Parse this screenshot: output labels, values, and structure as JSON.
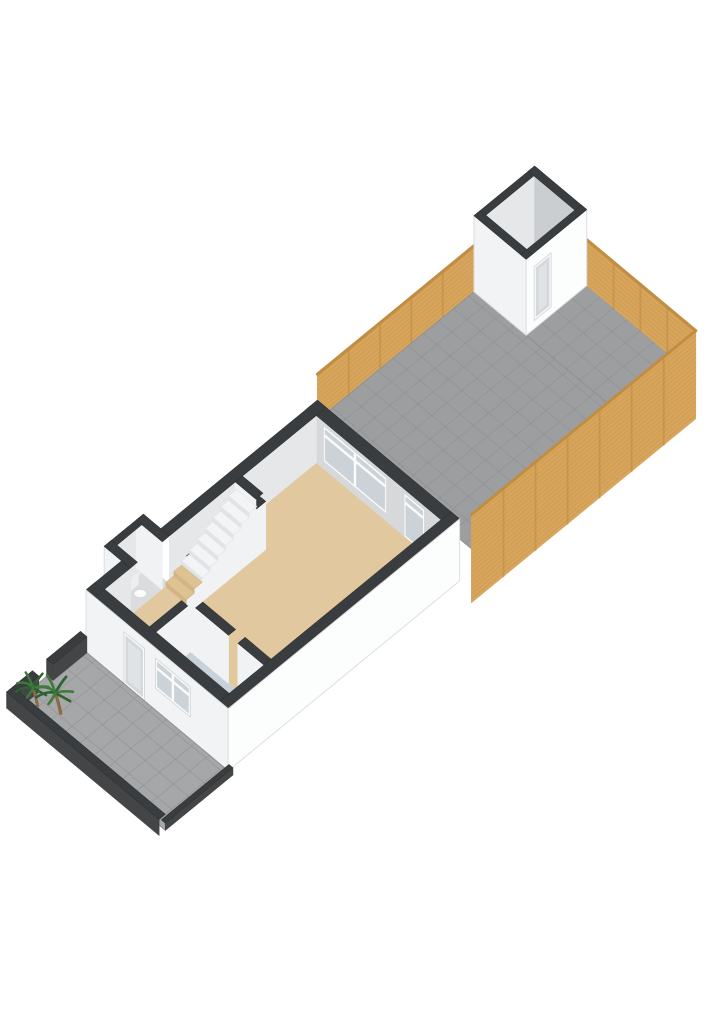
{
  "meta": {
    "view": "3d-floorplan-ground-floor-with-garden",
    "background": "#ffffff"
  },
  "palette": {
    "background": "#ffffff",
    "wallTop": "#3a3d3f",
    "wallTopStroke": "#2f3234",
    "extWhite": "#f2f3f5",
    "extWhiteBright": "#fcfdfd",
    "extEdge": "#dcdee0",
    "innerGray": "#d6d8da",
    "innerGrayLight": "#e5e7e9",
    "innerGrayDark": "#cbced0",
    "intWallFace": "#f1f2f3",
    "floorBeige": "#e2c89e",
    "floorBeigeEdge": "#d6ba8e",
    "stepBeige": "#dec292",
    "stepBeigeRiser": "#d2b485",
    "vestibuleBlue": "#c8d2da",
    "wcFloor": "#dadcde",
    "pavingGray": "#a5a7a9",
    "gardenPaving": "#9c9ea0",
    "pavingGrid": "#8b8d8f",
    "pavingEdge": "#8f9193",
    "wood": "#d8a55c",
    "woodDark": "#b9873c",
    "woodRail": "#c08d42",
    "stepWhite": "#f3f4f5",
    "stepRiser": "#e1e3e5",
    "glass": "#ccd3d8",
    "frame": "#fafbfb",
    "frameEdge": "#d7dadc",
    "doorPanel": "#d5d8da",
    "doorInset": "#e0e3e5",
    "shedFloor": "#a9abad",
    "lowWallFace": "#434547",
    "plantGreen": "#3e7b3c",
    "plantGreenDark": "#2e6330",
    "trunk": "#8a6a42",
    "toiletWhite": "#fafbfc",
    "toiletEdge": "#d7dadc"
  },
  "scene": {
    "projection": {
      "origin": [
        86,
        652
      ],
      "eu": [
        17.8,
        -14.6
      ],
      "ev": [
        15.8,
        13.2
      ]
    },
    "elevations": {
      "street": 0,
      "floor": 14,
      "garden": 42,
      "houseWallTop": 62,
      "fenceTop": 88,
      "shedWallTop": 118,
      "lowWallTop": 16
    },
    "items": [
      {
        "name": "garden-fence-left",
        "type": "wallV",
        "v": 0,
        "u": [
          13,
          21.8
        ],
        "e": [
          42,
          88
        ],
        "fill": "wood",
        "slats": true,
        "postStep": 1.76,
        "rail": true
      },
      {
        "name": "garden-paving-main",
        "type": "hquad",
        "u": [
          13,
          21.8
        ],
        "v": [
          0,
          10.2
        ],
        "e": 42,
        "fill": "gardenPaving",
        "grid": 0.85,
        "stroke": "pavingEdge"
      },
      {
        "name": "garden-paving-back",
        "type": "hquad",
        "u": [
          21.8,
          25.2
        ],
        "v": [
          3.3,
          10.2
        ],
        "e": 42,
        "fill": "gardenPaving",
        "grid": 0.85,
        "stroke": "pavingEdge"
      },
      {
        "name": "garden-plant",
        "type": "tuft",
        "at": [
          22.6,
          9.5,
          42
        ]
      },
      {
        "name": "garden-fence-back",
        "type": "wallU",
        "u": 25.2,
        "v": [
          3.3,
          10.2
        ],
        "e": [
          42,
          88
        ],
        "fill": "wood",
        "slats": true,
        "postStep": 1.7,
        "rail": true
      },
      {
        "name": "shed-floor",
        "type": "hquad",
        "u": [
          21.8,
          25.2
        ],
        "v": [
          0,
          3.3
        ],
        "e": 42,
        "fill": "shedFloor"
      },
      {
        "name": "shed-wall-back-left-inner",
        "type": "wallV",
        "v": 0,
        "u": [
          21.8,
          25.2
        ],
        "e": [
          42,
          118
        ],
        "fill": "innerGrayLight"
      },
      {
        "name": "shed-wall-back-right-inner",
        "type": "wallU",
        "u": 25.2,
        "v": [
          0,
          3.3
        ],
        "e": [
          42,
          118
        ],
        "fill": "innerGrayDark"
      },
      {
        "name": "shed-wall-back-left-top",
        "type": "hquad",
        "u": [
          21.8,
          25.2
        ],
        "v": [
          0,
          0.35
        ],
        "e": 118,
        "fill": "wallTop"
      },
      {
        "name": "shed-wall-back-right-top",
        "type": "hquad",
        "u": [
          24.85,
          25.2
        ],
        "v": [
          0,
          3.3
        ],
        "e": 118,
        "fill": "wallTop"
      },
      {
        "name": "shed-wall-front-left",
        "type": "wallU",
        "u": 21.8,
        "v": [
          0,
          3.3
        ],
        "e": [
          42,
          118
        ],
        "fill": "extWhite",
        "stroke": "extEdge"
      },
      {
        "name": "shed-wall-front-left-top",
        "type": "hquad",
        "u": [
          21.8,
          22.15
        ],
        "v": [
          0,
          3.3
        ],
        "e": 118,
        "fill": "wallTop"
      },
      {
        "name": "shed-wall-front-right",
        "type": "wallV",
        "v": 3.3,
        "u": [
          21.8,
          25.2
        ],
        "e": [
          42,
          118
        ],
        "fill": "extWhiteBright",
        "stroke": "extEdge"
      },
      {
        "name": "shed-door",
        "type": "winV",
        "v": 3.3,
        "u": [
          22.25,
          23.2
        ],
        "e": [
          50,
          104
        ],
        "style": "door"
      },
      {
        "name": "shed-wall-front-right-top",
        "type": "hquad",
        "u": [
          21.8,
          25.2
        ],
        "v": [
          2.95,
          3.3
        ],
        "e": 118,
        "fill": "wallTop"
      },
      {
        "name": "garden-fence-right",
        "type": "wallV",
        "v": 10.2,
        "u": [
          12.6,
          25.2
        ],
        "e": [
          0,
          88
        ],
        "fill": "wood",
        "slats": true,
        "postStep": 1.8,
        "rail": true
      },
      {
        "name": "house-wall-rear-inner",
        "type": "wallU",
        "u": 12.45,
        "v": [
          0.55,
          8.45
        ],
        "e": [
          14,
          62
        ],
        "fill": "innerGray"
      },
      {
        "name": "rear-window",
        "type": "winU",
        "u": 12.45,
        "v": [
          1.0,
          5.0
        ],
        "e": [
          22,
          58
        ],
        "style": "window",
        "cols": 2,
        "transom": true
      },
      {
        "name": "rear-garden-door",
        "type": "winU",
        "u": 12.45,
        "v": [
          6.1,
          7.4
        ],
        "e": [
          14,
          58
        ],
        "style": "glassdoor",
        "cols": 1,
        "transom": true
      },
      {
        "name": "wc-floor",
        "type": "hquad",
        "u": [
          2.0,
          4.2
        ],
        "v": [
          -1.1,
          0.55
        ],
        "e": 14,
        "fill": "wcFloor"
      },
      {
        "name": "wc-wall-left-inner",
        "type": "wallV",
        "v": -0.75,
        "u": [
          2.0,
          4.2
        ],
        "e": [
          14,
          62
        ],
        "fill": "innerGrayLight"
      },
      {
        "name": "wc-wall-rear-inner",
        "type": "wallU",
        "u": 3.8,
        "v": [
          -1.1,
          0.55
        ],
        "e": [
          14,
          62
        ],
        "fill": "intWallFace"
      },
      {
        "name": "toilet",
        "type": "toilet",
        "at": [
          3.05,
          -0.35,
          14
        ]
      },
      {
        "name": "wc-wall-front-ext",
        "type": "wallU",
        "u": 2.0,
        "v": [
          -1.1,
          0.55
        ],
        "e": [
          0,
          62
        ],
        "fill": "extWhite",
        "stroke": "extEdge"
      },
      {
        "name": "wc-wall-left-top",
        "type": "hquad",
        "u": [
          2.0,
          4.2
        ],
        "v": [
          -1.1,
          -0.75
        ],
        "e": 62,
        "fill": "wallTop"
      },
      {
        "name": "wc-wall-front-top",
        "type": "hquad",
        "u": [
          2.0,
          2.4
        ],
        "v": [
          -1.1,
          0.55
        ],
        "e": 62,
        "fill": "wallTop"
      },
      {
        "name": "wc-wall-rear-top",
        "type": "hquad",
        "u": [
          3.8,
          4.2
        ],
        "v": [
          -1.1,
          0.55
        ],
        "e": 62,
        "fill": "wallTop"
      },
      {
        "name": "house-wall-left-inner-front",
        "type": "wallV",
        "v": 0.55,
        "u": [
          0.55,
          2.0
        ],
        "e": [
          14,
          62
        ],
        "fill": "innerGrayLight"
      },
      {
        "name": "house-wall-left-inner-rear",
        "type": "wallV",
        "v": 0.55,
        "u": [
          4.2,
          12.45
        ],
        "e": [
          14,
          62
        ],
        "fill": "innerGrayLight"
      },
      {
        "name": "living-room-floor",
        "type": "hquad",
        "u": [
          0.55,
          12.45
        ],
        "v": [
          0.55,
          8.45
        ],
        "e": 14,
        "fill": "floorBeige"
      },
      {
        "name": "vestibule-floor",
        "type": "hquad",
        "u": [
          0.55,
          2.5
        ],
        "v": [
          3.8,
          6.8
        ],
        "e": 14.3,
        "fill": "vestibuleBlue"
      },
      {
        "name": "wall-vestibule-left-face",
        "type": "wallV",
        "v": 3.8,
        "u": [
          0.55,
          2.5
        ],
        "e": [
          14,
          62
        ],
        "fill": "intWallFace"
      },
      {
        "name": "wall-vestibule-left-top",
        "type": "hquad",
        "u": [
          0.55,
          2.5
        ],
        "v": [
          3.4,
          3.8
        ],
        "e": 62,
        "fill": "wallTop"
      },
      {
        "name": "wall-vestibule-rear-face",
        "type": "wallU",
        "u": 2.5,
        "v": [
          3.8,
          6.2
        ],
        "e": [
          14,
          62
        ],
        "fill": "intWallFace"
      },
      {
        "name": "wall-vestibule-rear-top",
        "type": "hquad",
        "u": [
          2.5,
          2.9
        ],
        "v": [
          3.8,
          6.2
        ],
        "e": 62,
        "fill": "wallTop"
      },
      {
        "name": "wall-front-right-stub-face",
        "type": "wallU",
        "u": 2.5,
        "v": [
          6.8,
          8.45
        ],
        "e": [
          14,
          62
        ],
        "fill": "intWallFace"
      },
      {
        "name": "wall-front-right-stub-top",
        "type": "hquad",
        "u": [
          2.5,
          2.9
        ],
        "v": [
          6.8,
          8.45
        ],
        "e": 62,
        "fill": "wallTop"
      },
      {
        "name": "wall-stairs-face",
        "type": "wallV",
        "v": 2.25,
        "u": [
          4.0,
          8.1
        ],
        "e": [
          14,
          62
        ],
        "fill": "intWallFace"
      },
      {
        "name": "wall-stairs-end-face",
        "type": "wallU",
        "u": 4.0,
        "v": [
          1.85,
          2.25
        ],
        "e": [
          14,
          62
        ],
        "fill": "intWallFace"
      },
      {
        "name": "wall-stairs-top",
        "type": "hquad",
        "u": [
          4.0,
          8.1
        ],
        "v": [
          1.85,
          2.25
        ],
        "e": 62,
        "fill": "wallTop"
      },
      {
        "name": "wall-stairs-rear-stub-face",
        "type": "wallU",
        "u": 7.9,
        "v": [
          0.55,
          1.85
        ],
        "e": [
          14,
          62
        ],
        "fill": "intWallFace"
      },
      {
        "name": "wall-stairs-rear-stub-top",
        "type": "hquad",
        "u": [
          7.9,
          8.3
        ],
        "v": [
          0.55,
          1.85
        ],
        "e": 62,
        "fill": "wallTop"
      },
      {
        "name": "staircase",
        "type": "steps",
        "u0": 4.0,
        "du": 0.44,
        "n": 9,
        "v": [
          0.55,
          1.85
        ],
        "e0": 14,
        "de": 4.4,
        "beige": 2
      },
      {
        "name": "house-wall-front-top",
        "type": "hquad",
        "u": [
          0,
          0.55
        ],
        "v": [
          0,
          9
        ],
        "e": 62,
        "fill": "wallTop"
      },
      {
        "name": "house-wall-rear-top",
        "type": "hquad",
        "u": [
          12.45,
          13
        ],
        "v": [
          0,
          9
        ],
        "e": 62,
        "fill": "wallTop"
      },
      {
        "name": "house-wall-left-top-front",
        "type": "hquad",
        "u": [
          0,
          2.0
        ],
        "v": [
          0,
          0.55
        ],
        "e": 62,
        "fill": "wallTop"
      },
      {
        "name": "house-wall-left-top-rear",
        "type": "hquad",
        "u": [
          4.2,
          13
        ],
        "v": [
          0,
          0.55
        ],
        "e": 62,
        "fill": "wallTop"
      },
      {
        "name": "house-wall-right-top",
        "type": "hquad",
        "u": [
          0,
          13
        ],
        "v": [
          8.45,
          9
        ],
        "e": 62,
        "fill": "wallTop"
      },
      {
        "name": "house-front-facade",
        "type": "wallU",
        "u": 0,
        "v": [
          0,
          9
        ],
        "e": [
          0,
          62
        ],
        "fill": "extWhite",
        "stroke": "extEdge"
      },
      {
        "name": "front-door",
        "type": "winU",
        "u": 0,
        "v": [
          2.4,
          3.7
        ],
        "e": [
          0,
          52
        ],
        "style": "door"
      },
      {
        "name": "front-window",
        "type": "winU",
        "u": 0,
        "v": [
          4.4,
          6.6
        ],
        "e": [
          22,
          52
        ],
        "style": "window",
        "cols": 2,
        "transom": true
      },
      {
        "name": "house-side-facade",
        "type": "wallV",
        "v": 9,
        "u": [
          0,
          13
        ],
        "e": [
          0,
          62
        ],
        "fill": "extWhiteBright",
        "stroke": "extEdge"
      },
      {
        "name": "front-yard-paving",
        "type": "hquad",
        "u": [
          -3.8,
          0
        ],
        "v": [
          -0.3,
          9.3
        ],
        "e": 0,
        "fill": "pavingGray",
        "grid": 0.9,
        "stroke": "pavingEdge"
      },
      {
        "name": "front-yard-wall-left-a-face",
        "type": "wallV",
        "v": 0.05,
        "u": [
          -3.8,
          -2.7
        ],
        "e": [
          0,
          16
        ],
        "fill": "lowWallFace"
      },
      {
        "name": "front-yard-wall-left-a-cap",
        "type": "wallU",
        "u": -2.7,
        "v": [
          -0.35,
          0.05
        ],
        "e": [
          0,
          16
        ],
        "fill": "lowWallFace"
      },
      {
        "name": "front-yard-wall-left-a-top",
        "type": "hquad",
        "u": [
          -3.8,
          -2.7
        ],
        "v": [
          -0.35,
          0.05
        ],
        "e": 16,
        "fill": "wallTop"
      },
      {
        "name": "front-yard-wall-left-b-face",
        "type": "wallV",
        "v": 0.05,
        "u": [
          -1.9,
          0
        ],
        "e": [
          0,
          16
        ],
        "fill": "lowWallFace"
      },
      {
        "name": "front-yard-wall-left-b-cap",
        "type": "wallU",
        "u": -1.9,
        "v": [
          -0.35,
          0.05
        ],
        "e": [
          0,
          16
        ],
        "fill": "lowWallFace"
      },
      {
        "name": "front-yard-wall-left-b-top",
        "type": "hquad",
        "u": [
          -1.9,
          0
        ],
        "v": [
          -0.35,
          0.05
        ],
        "e": 16,
        "fill": "wallTop"
      },
      {
        "name": "front-yard-wall-street-face",
        "type": "wallU",
        "u": -4.15,
        "v": [
          -0.35,
          9.3
        ],
        "e": [
          0,
          16
        ],
        "fill": "lowWallFace"
      },
      {
        "name": "front-yard-wall-street-top",
        "type": "hquad",
        "u": [
          -4.15,
          -3.8
        ],
        "v": [
          -0.35,
          9.3
        ],
        "e": 16,
        "fill": "wallTop"
      },
      {
        "name": "front-yard-curb-right-face",
        "type": "wallV",
        "v": 9.3,
        "u": [
          -3.8,
          0
        ],
        "e": [
          0,
          7
        ],
        "fill": "lowWallFace"
      },
      {
        "name": "front-yard-curb-right-top",
        "type": "hquad",
        "u": [
          -3.8,
          0
        ],
        "v": [
          9.05,
          9.3
        ],
        "e": 7,
        "fill": "wallTop"
      },
      {
        "name": "palm-plant-1",
        "type": "palm",
        "at": [
          -3.2,
          0.55,
          0
        ],
        "s": 1.2
      },
      {
        "name": "palm-plant-2",
        "type": "palm",
        "at": [
          -2.8,
          1.55,
          0
        ],
        "s": 1.35
      }
    ]
  }
}
